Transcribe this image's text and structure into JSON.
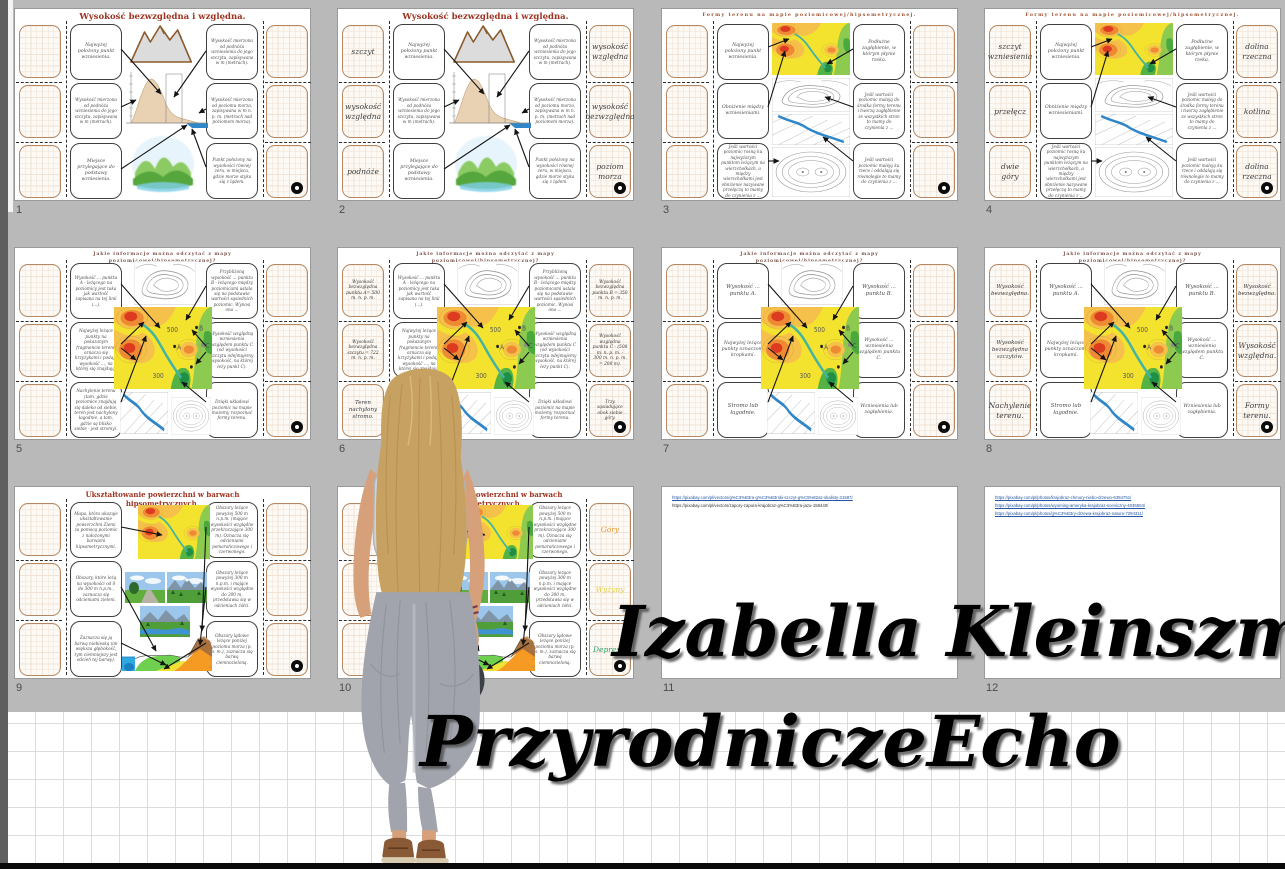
{
  "branding": {
    "line1": "Izabella Kleinszmidt –",
    "line2": "PrzyrodniczeEcho",
    "text_color": "#000000"
  },
  "colors": {
    "background": "#b9b9b9",
    "slide_bg": "#ffffff",
    "title_red": "#9c3320",
    "answer_border_tan": "#b58863",
    "map_yellow": "#f3e32f",
    "map_orange": "#ee8a33",
    "map_red": "#dd3b1f",
    "map_green": "#55b244",
    "river_blue": "#2f86c8",
    "link_blue": "#2456a4"
  },
  "icons": {
    "slide_action": "hide-answer-circle"
  },
  "slides": [
    {
      "number": "1",
      "kind": "heights",
      "title": "Wysokość bezwzględna i względna.",
      "left_clues": [
        "Najwyżej położony punkt wzniesienia.",
        "Wysokość mierzona od podnóża wzniesienia do jego szczytu, zapisywana w m (metrach).",
        "Miejsce przylegające do podstawy wzniesienia."
      ],
      "right_clues": [
        "Wysokość mierzona od podnóża wzniesienia do jego szczytu, zapisywana w m (metrach).",
        "Wysokość mierzona od poziomu morza, zapisywana w m n. p. m. (metrach nad poziomem morza).",
        "Punkt położony na wysokości równej zeru, w miejscu, gdzie morze styka się z lądem."
      ],
      "left_answers": [],
      "right_answers": []
    },
    {
      "number": "2",
      "kind": "heights",
      "title": "Wysokość bezwzględna i względna.",
      "left_clues": [
        "Najwyżej położony punkt wzniesienia.",
        "Wysokość mierzona od podnóża wzniesienia do jego szczytu, zapisywana w m (metrach).",
        "Miejsce przylegające do podstawy wzniesienia."
      ],
      "right_clues": [
        "Wysokość mierzona od podnóża wzniesienia do jego szczytu, zapisywana w m (metrach).",
        "Wysokość mierzona od poziomu morza, zapisywana w m n. p. m. (metrach nad poziomem morza).",
        "Punkt położony na wysokości równej zeru, w miejscu, gdzie morze styka się z lądem."
      ],
      "left_answers": [
        {
          "text": "szczyt"
        },
        {
          "text": "wysokość względna"
        },
        {
          "text": "podnóże"
        }
      ],
      "right_answers": [
        {
          "text": "wysokość względna"
        },
        {
          "text": "wysokość bezwzględna"
        },
        {
          "text": "poziom morza"
        }
      ]
    },
    {
      "number": "3",
      "kind": "forms",
      "title": "Formy terenu na mapie poziomicowej/hipsometrycznej.",
      "left_clues": [
        "Najwyżej położony punkt wzniesienia.",
        "Obniżenie między wzniesieniami.",
        "Jeśli wartości poziomic rosną ku najwyższym punktom leżącym na wierzchołkach, a między wierzchołkami jest obniżenie nazywane przełęczą to mamy do czynienia z ..."
      ],
      "right_clues": [
        "Podłużne zagłębienie, w którym płynie rzeka.",
        "Jeśli wartości poziomic maleją do środka formy terenu i tworzą zagłębienie ze wszystkich stron to mamy do czynienia z ...",
        "Jeśli wartości poziomic maleją ku rzece i oddalają się równolegle to mamy do czynienia z ..."
      ],
      "left_answers": [],
      "right_answers": []
    },
    {
      "number": "4",
      "kind": "forms",
      "title": "Formy terenu na mapie poziomicowej/hipsometrycznej.",
      "left_clues": [
        "Najwyżej położony punkt wzniesienia.",
        "Obniżenie między wzniesieniami.",
        "Jeśli wartości poziomic rosną ku najwyższym punktom leżącym na wierzchołkach, a między wierzchołkami jest obniżenie nazywane przełęczą to mamy do czynienia z ..."
      ],
      "right_clues": [
        "Podłużne zagłębienie, w którym płynie rzeka.",
        "Jeśli wartości poziomic maleją do środka formy terenu i tworzą zagłębienie ze wszystkich stron to mamy do czynienia z ...",
        "Jeśli wartości poziomic maleją ku rzece i oddalają się równolegle to mamy do czynienia z ..."
      ],
      "left_answers": [
        {
          "text": "szczyt wzniesienia"
        },
        {
          "text": "przełęcz"
        },
        {
          "text": "dwie góry"
        }
      ],
      "right_answers": [
        {
          "text": "dolina rzeczna"
        },
        {
          "text": "kotlina"
        },
        {
          "text": "dolina rzeczna"
        }
      ]
    },
    {
      "number": "5",
      "kind": "mapinfo",
      "title": "Jakie informacje można odczytać z mapy poziomicowej/hipsometrycznej?",
      "left_clues": [
        "Wysokość ... punktu A - leżącego na poziomicy jest taka jak wartość zapisana na tej linii (...).",
        "Najwyżej leżące punkty na pokazanym fragmencie terenu oznacza się krzyżykami i podaje wysokość ..., na której się znajdują.",
        "Nachylenie terenu (tam, gdzie poziomice znajdują się daleko od siebie, teren jest nachylony łagodnie, a tam, gdzie są blisko siebie - jest stromy)."
      ],
      "right_clues": [
        "Przybliżoną wysokość ... punktu B - leżącego między poziomicami ustala się na podstawie wartości sąsiednich poziomic. Wynosi ona ...",
        "Wysokość względną wzniesienia względem punktu C (od wysokości szczytu odejmujemy wysokość, na której leży punkt C).",
        "Dzięki układowi poziomic na mapie możemy rozpoznać formy terenu."
      ],
      "left_answers": [],
      "right_answers": []
    },
    {
      "number": "6",
      "kind": "mapinfo",
      "title": "Jakie informacje można odczytać z mapy poziomicowej/hipsometrycznej?",
      "left_clues": [
        "Wysokość ... punktu A - leżącego na poziomicy jest taka jak wartość zapisana na tej linii (...).",
        "Najwyżej leżące punkty na pokazanym fragmencie terenu oznacza się krzyżykami i podaje wysokość ..., na której się znajdują.",
        "Nachylenie terenu (tam, gdzie poziomice znajdują się daleko od siebie, teren jest nachylony łagodnie, a tam, gdzie są blisko siebie - jest stromy)."
      ],
      "right_clues": [
        "Przybliżoną wysokość ... punktu B - leżącego między poziomicami ustala się na podstawie wartości sąsiednich poziomic. Wynosi ona ...",
        "Wysokość względną wzniesienia względem punktu C (od wysokości szczytu odejmujemy wysokość, na której leży punkt C).",
        "Dzięki układowi poziomic na mapie możemy rozpoznać formy terenu."
      ],
      "left_answers": [
        {
          "text": "Wysokość bezwzględna punktu A= 500 m. n. p. m."
        },
        {
          "text": "Wysokość bezwzględna szczytu = 722 m. n. p. m."
        },
        {
          "text": "Teren nachylony stromo."
        }
      ],
      "right_answers": [
        {
          "text": "Wysokość bezwzględna punktu B = 350 m. n. p. m."
        },
        {
          "text": "Wysokość względna punktu C - (508 m. n. p. m. - 300 m. n. p. m. = 208 m)."
        },
        {
          "text": "Trzy sąsiadujące obok siebie góry."
        }
      ]
    },
    {
      "number": "7",
      "kind": "mapinfo",
      "title": "Jakie informacje można odczytać z mapy poziomicowej/hipsometrycznej?",
      "left_clues": [
        "Wysokość ... punktu A.",
        "Najwyżej leżące punkty oznaczono kropkami.",
        "Stromo lub łagodnie."
      ],
      "right_clues": [
        "Wysokość ... punktu B.",
        "Wysokość ... wzniesienia względem punktu C.",
        "Wzniesienia lub zagłębienia."
      ],
      "left_answers": [],
      "right_answers": []
    },
    {
      "number": "8",
      "kind": "mapinfo",
      "title": "Jakie informacje można odczytać z mapy poziomicowej/hipsometrycznej?",
      "left_clues": [
        "Wysokość ... punktu A.",
        "Najwyżej leżące punkty oznaczono kropkami.",
        "Stromo lub łagodnie."
      ],
      "right_clues": [
        "Wysokość ... punktu B.",
        "Wysokość ... wzniesienia względem punktu C.",
        "Wzniesienia lub zagłębienia."
      ],
      "left_answers": [
        {
          "text": "Wysokość bezwzględna."
        },
        {
          "text": "Wysokość bezwzględna szczytów."
        },
        {
          "text": "Nachylenie terenu."
        }
      ],
      "right_answers": [
        {
          "text": "Wysokość bezwzględna."
        },
        {
          "text": "Wysokość względna."
        },
        {
          "text": "Formy terenu."
        }
      ]
    },
    {
      "number": "9",
      "kind": "colors",
      "title": "Ukształtowanie powierzchni w barwach hipsometrycznych.",
      "left_clues": [
        "Mapa, która ukazuje ukształtowanie powierzchni Ziemi za pomocą poziomic z nałożonymi barwami hipsometrycznymi.",
        "Obszary, które leżą na wysokości od 0 do 300 m n.p.m., zaznacza się odcieniami zieleni.",
        "Zaznacza się ją barwą niebieską (im większa głębokość, tym ciemniejszy jest odcień tej barwy)."
      ],
      "right_clues": [
        "Obszary leżące powyżej 500 m n.p.m. (mające wysokości względne przekraczające 300 m). Oznacza się odcieniami pomarańczowego i czerwonego.",
        "Obszary leżące powyżej 300 m n.p.m. i mające wysokości względne do 300 m, przedstawia się w odcieniach żółci.",
        "Obszary lądowe leżące poniżej poziomu morza (p. p. m.), zaznacza się barwą ciemnozieloną."
      ],
      "left_answers": [],
      "right_answers": []
    },
    {
      "number": "10",
      "kind": "colors",
      "title": "Ukształtowanie powierzchni w barwach hipsometrycznych.",
      "left_clues": [
        "Mapa, która ukazuje ukształtowanie powierzchni Ziemi za pomocą poziomic z nałożonymi barwami hipsometrycznymi.",
        "Obszary, które leżą na wysokości od 0 do 300 m n.p.m., zaznacza się odcieniami zieleni.",
        "Zaznacza się ją barwą niebieską (im większa głębokość, tym ciemniejszy jest odcień tej barwy)."
      ],
      "right_clues": [
        "Obszary leżące powyżej 500 m n.p.m. (mające wysokości względne przekraczające 300 m). Oznacza się odcieniami pomarańczowego i czerwonego.",
        "Obszary leżące powyżej 300 m n.p.m. i mające wysokości względne do 300 m, przedstawia się w odcieniach żółci.",
        "Obszary lądowe leżące poniżej poziomu morza (p. p. m.), zaznacza się barwą ciemnozieloną."
      ],
      "left_answers": [],
      "right_answers": [
        {
          "text": "Góry",
          "color": "#e8972f"
        },
        {
          "text": "Wyżyny",
          "color": "#e5cf3c"
        },
        {
          "text": "Depresje",
          "color": "#2f9e68"
        }
      ]
    },
    {
      "number": "11",
      "kind": "links",
      "links": [
        {
          "text": "https://pixabay.com/pl/vectors/g%C3%B3ra-g%C3%B3rski-szczyt-g%C5%82az-skalisty-31587/",
          "link": true
        },
        {
          "text": "https://pixabay.com/pl/vectors/zapory-zapora-krajobraz-g%C3%B3ra-jazu-158440/",
          "link": false
        }
      ]
    },
    {
      "number": "12",
      "kind": "links",
      "links": [
        {
          "text": "https://pixabay.com/pl/photos/krajobraz-chmury-niebo-drzewo-6394751/",
          "link": true
        },
        {
          "text": "https://pixabay.com/pl/photos/wyoming-ameryka-krajobraz-sceniczny-4036504/",
          "link": true
        },
        {
          "text": "https://pixabay.com/pl/photos/g%C3%B3ry-drzewa-krajobraz-natura-7294311/",
          "link": true
        }
      ]
    }
  ]
}
